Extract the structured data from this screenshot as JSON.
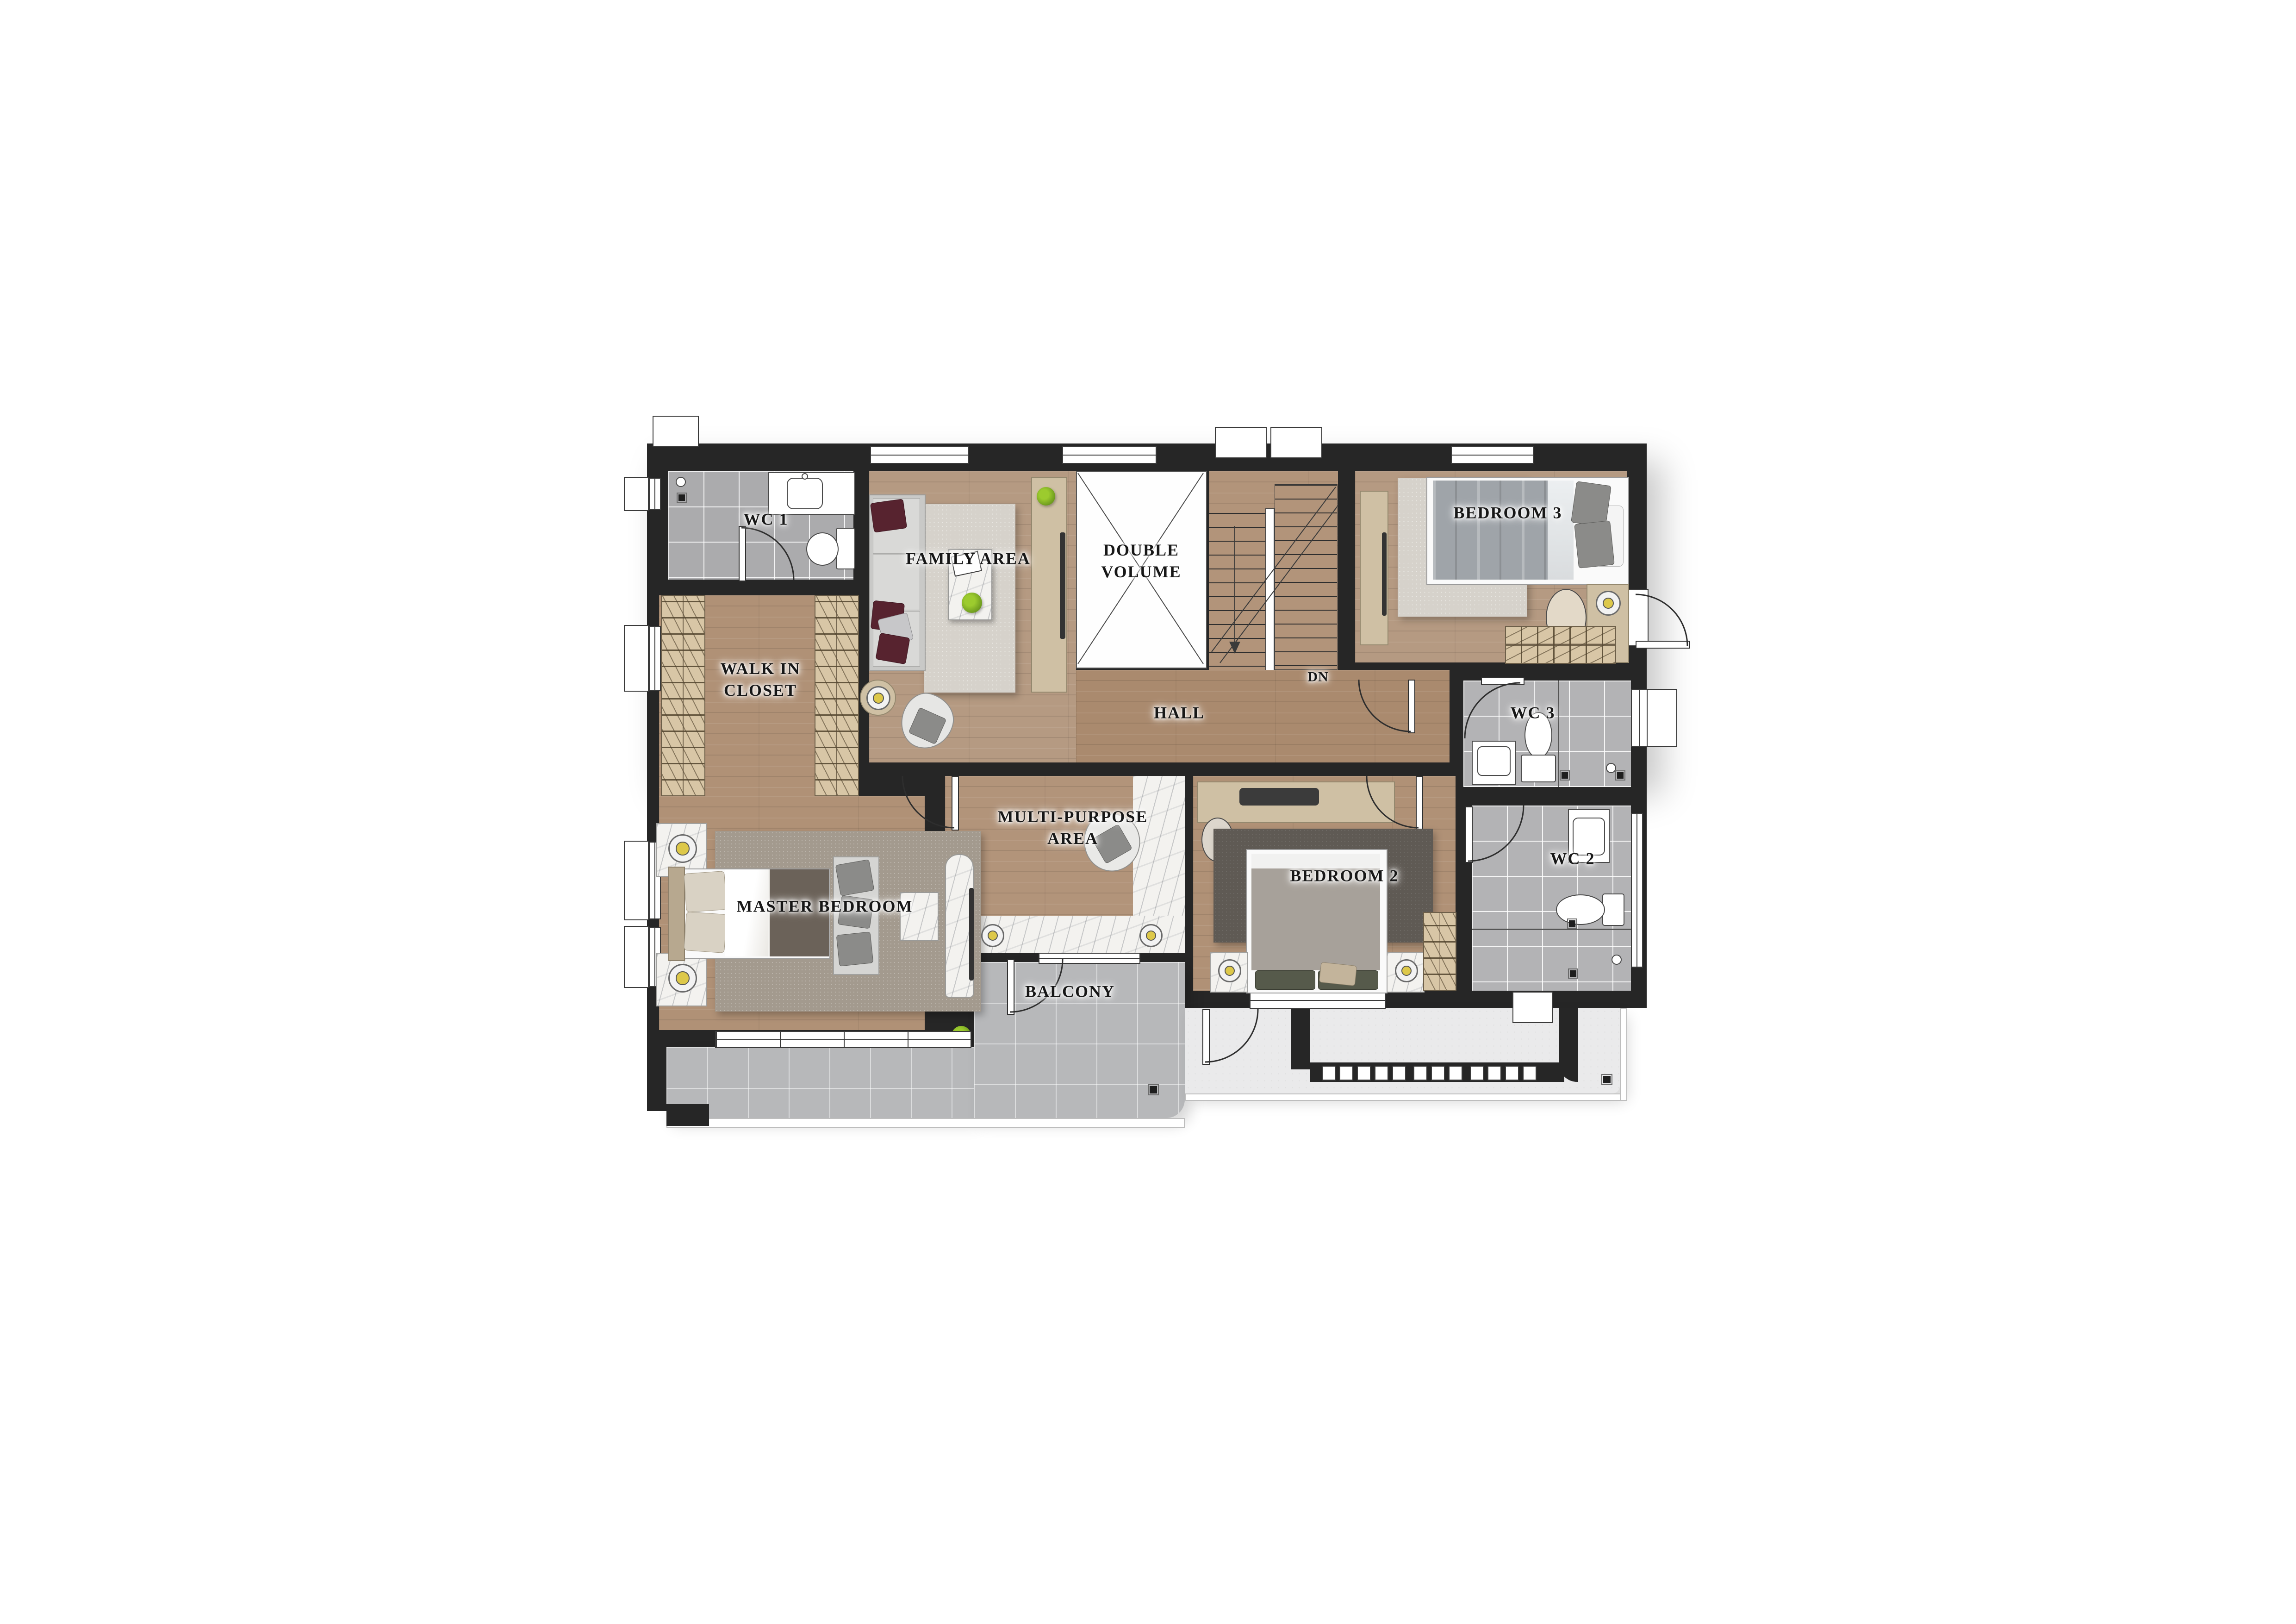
{
  "plan": {
    "title": "Upper floor plan",
    "rooms": [
      {
        "id": "wc1",
        "label": "WC 1"
      },
      {
        "id": "family_area",
        "label": "FAMILY AREA"
      },
      {
        "id": "double_volume",
        "label": "DOUBLE VOLUME",
        "line1": "DOUBLE",
        "line2": "VOLUME"
      },
      {
        "id": "bedroom3",
        "label": "BEDROOM 3"
      },
      {
        "id": "walk_in_closet",
        "label": "WALK IN CLOSET",
        "line1": "WALK IN",
        "line2": "CLOSET"
      },
      {
        "id": "hall",
        "label": "HALL"
      },
      {
        "id": "wc3",
        "label": "WC 3"
      },
      {
        "id": "multi_purpose_area",
        "label": "MULTI-PURPOSE AREA",
        "line1": "MULTI-PURPOSE",
        "line2": "AREA"
      },
      {
        "id": "master_bedroom",
        "label": "MASTER BEDROOM"
      },
      {
        "id": "bedroom2",
        "label": "BEDROOM 2"
      },
      {
        "id": "wc2",
        "label": "WC 2"
      },
      {
        "id": "balcony",
        "label": "BALCONY"
      }
    ],
    "stair_direction_label": "DN",
    "colors": {
      "wall": "#262626",
      "wood_floor": "#b09176",
      "hall_wood": "#aa8a6e",
      "bathroom_tile": "#b3b3b5",
      "marble": "#f3f2ef",
      "balcony_tile": "#b7b8ba",
      "terrace": "#eaeaeb",
      "rug_light": "#d6d2cb",
      "rug_master": "#a39a8e",
      "rug_dark": "#5f5a54",
      "wardrobe": "#d8c6a6",
      "duvet_master": "#6b6259",
      "duvet_bedroom2": "#a7a19a",
      "duvet_bedroom3": "#9fa4a9",
      "pillow_maroon": "#57232f",
      "lamp_yellow": "#ddc84a",
      "plant_green": "#6f9c1f",
      "label_text": "#171717"
    }
  }
}
